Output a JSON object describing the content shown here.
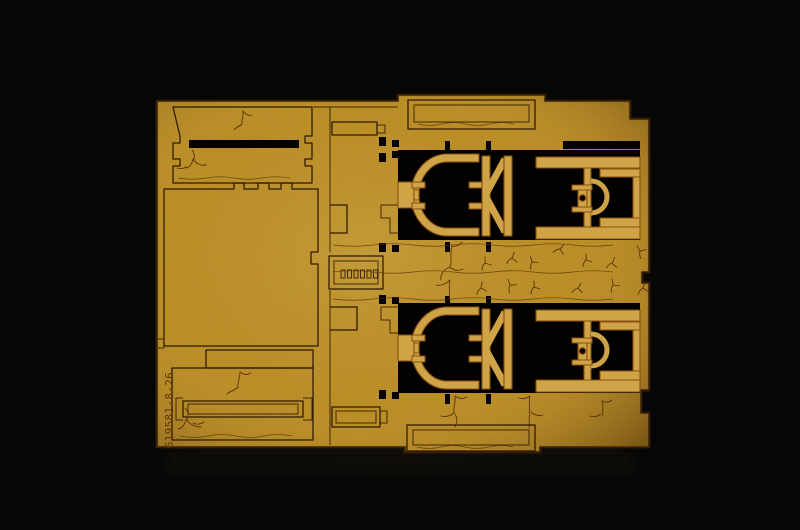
{
  "image": {
    "alt": "Photograph of a tan laser-cut MDF model kit parts sheet on a black background",
    "width": 800,
    "height": 530
  },
  "sheet": {
    "engraved_code": "619581-8-26"
  },
  "colors": {
    "background": "#060606",
    "board": "#c6992e",
    "board_mid": "#cfa446",
    "board_light": "#debb63",
    "board_dark": "#9a7221",
    "board_edge": "#7c5a17",
    "cut_line": "#2e1804",
    "burn": "#8a4f12",
    "engrave": "#5c3408",
    "cutout": "#030201",
    "reflection": "#2a2017"
  }
}
